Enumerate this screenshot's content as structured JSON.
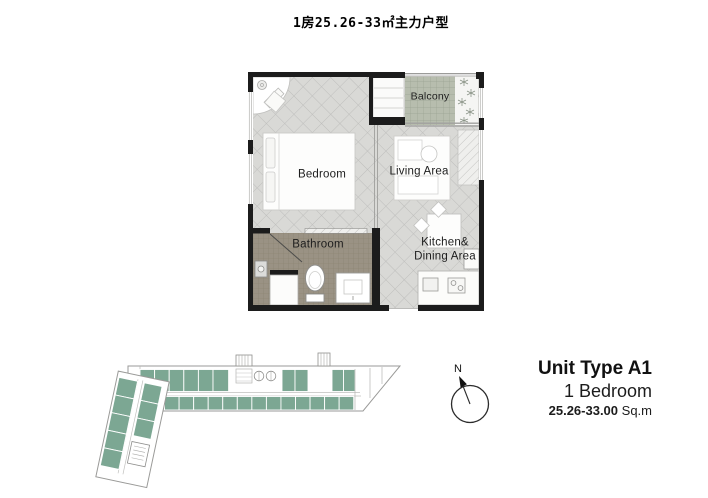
{
  "title": "1房25.26-33㎡主力户型",
  "floor_plan": {
    "rooms": {
      "bedroom": "Bedroom",
      "living": "Living Area",
      "balcony": "Balcony",
      "bathroom": "Bathroom",
      "kitchen_line1": "Kitchen&",
      "kitchen_line2": "Dining Area"
    }
  },
  "compass": {
    "north_label": "N"
  },
  "unit_info": {
    "type": "Unit Type A1",
    "bedrooms": "1 Bedroom",
    "area_value": "25.26-33.00",
    "area_unit": "Sq.m"
  },
  "colors": {
    "wall": "#1c1c1c",
    "tile_floor": "#d9d9d6",
    "tile_line": "#bdbdbb",
    "balcony_floor": "#b7bdae",
    "bathroom_floor": "#9a9284",
    "unit_highlight": "#7ca793"
  }
}
